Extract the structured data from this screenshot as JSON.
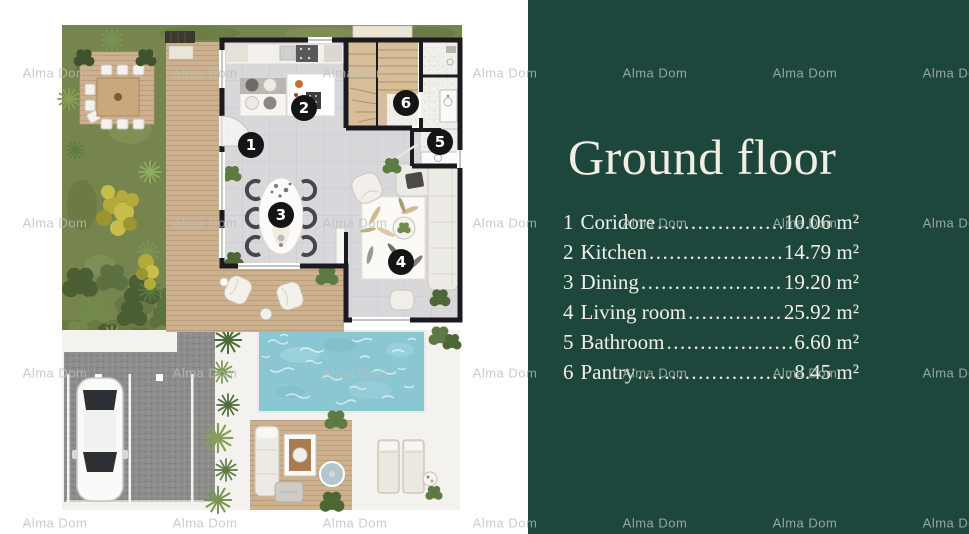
{
  "watermark": {
    "text": "Alma Dom"
  },
  "panel": {
    "title": "Ground floor",
    "leader": "..........................................................................",
    "legend": [
      {
        "num": "1",
        "name": "Coridore",
        "area": "10.06 m²"
      },
      {
        "num": "2",
        "name": "Kitchen",
        "area": "14.79 m²"
      },
      {
        "num": "3",
        "name": "Dining",
        "area": "19.20 m²"
      },
      {
        "num": "4",
        "name": "Living room",
        "area": "25.92 m²"
      },
      {
        "num": "5",
        "name": "Bathroom",
        "area": "6.60 m²"
      },
      {
        "num": "6",
        "name": "Pantry",
        "area": "8.45 m²"
      }
    ]
  },
  "floorplan": {
    "markers": [
      "1",
      "2",
      "3",
      "4",
      "5",
      "6"
    ]
  },
  "colors": {
    "panel_bg": "#1d473c",
    "panel_text": "#f1eee3",
    "watermark": "#b7c1ba",
    "wall": "#1b1b1f",
    "marker_bg": "#151515",
    "pool": "#8ac7d3",
    "deck": "#cdb08d",
    "grass": "#76844d",
    "asphalt": "#8e8d8b",
    "tile_floor": "#d8d8db"
  }
}
